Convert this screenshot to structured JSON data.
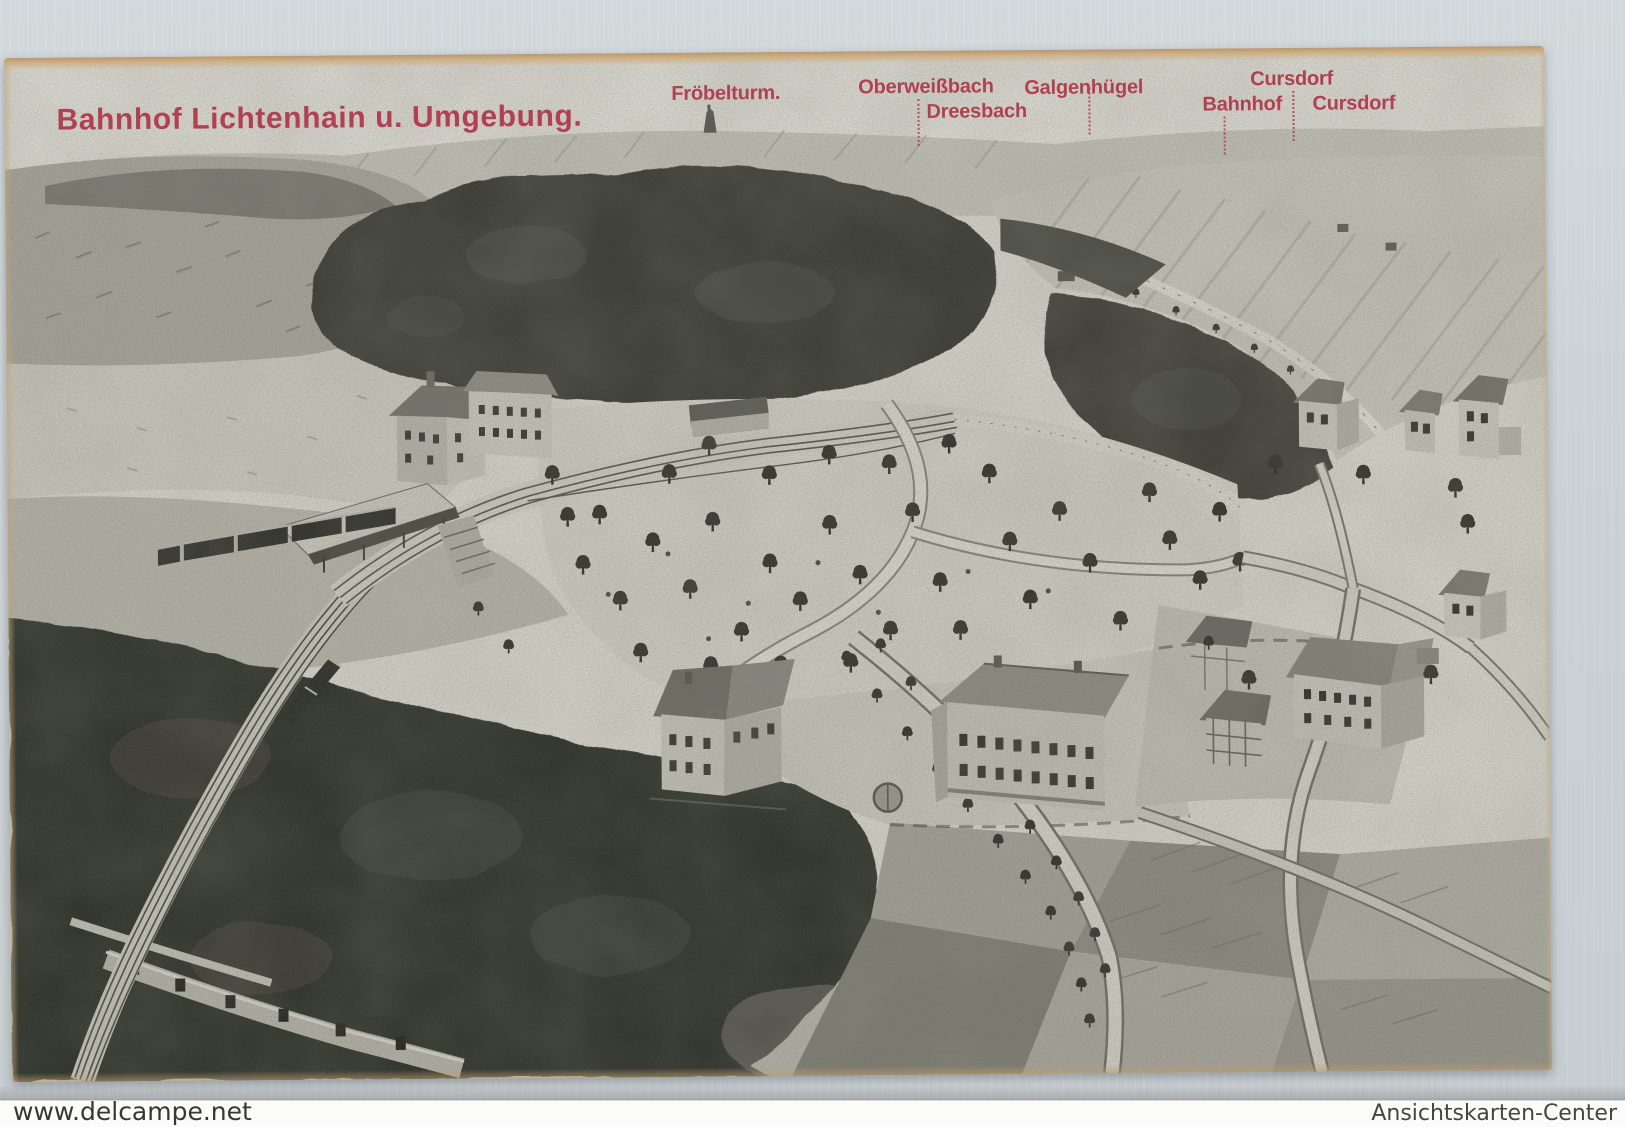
{
  "page": {
    "background_color": "#ccd2d6",
    "watermarks": {
      "left": "www.delcampe.net",
      "right": "Ansichtskarten-Center"
    }
  },
  "postcard": {
    "title": "Bahnhof Lichtenhain u. Umgebung.",
    "ink_color": "#b04052",
    "paper_color": "#d9d8ce",
    "labels": {
      "froebelturm": "Fröbelturm.",
      "oberweissbach": "Oberweißbach",
      "dreesbach": "Dreesbach",
      "galgenhuegel": "Galgenhügel",
      "cursdorf_upper": "Cursdorf",
      "bahnhof": "Bahnhof",
      "cursdorf_lower": "Cursdorf"
    },
    "scene": {
      "style": "monochrome lithographic bird's-eye view",
      "features": [
        "froebelturm-silhouette",
        "distant-field-hills",
        "dark-forest-masses",
        "left-meadow-hill",
        "railway-station",
        "station-canopy",
        "passenger-train",
        "freight-train",
        "railway-tracks",
        "arched-embankment",
        "park-with-scattered-trees",
        "winding-park-path",
        "tree-lined-road",
        "villa",
        "long-guesthouse-building",
        "village-houses",
        "half-timbered-house",
        "field-patchwork",
        "country-roads"
      ]
    }
  }
}
